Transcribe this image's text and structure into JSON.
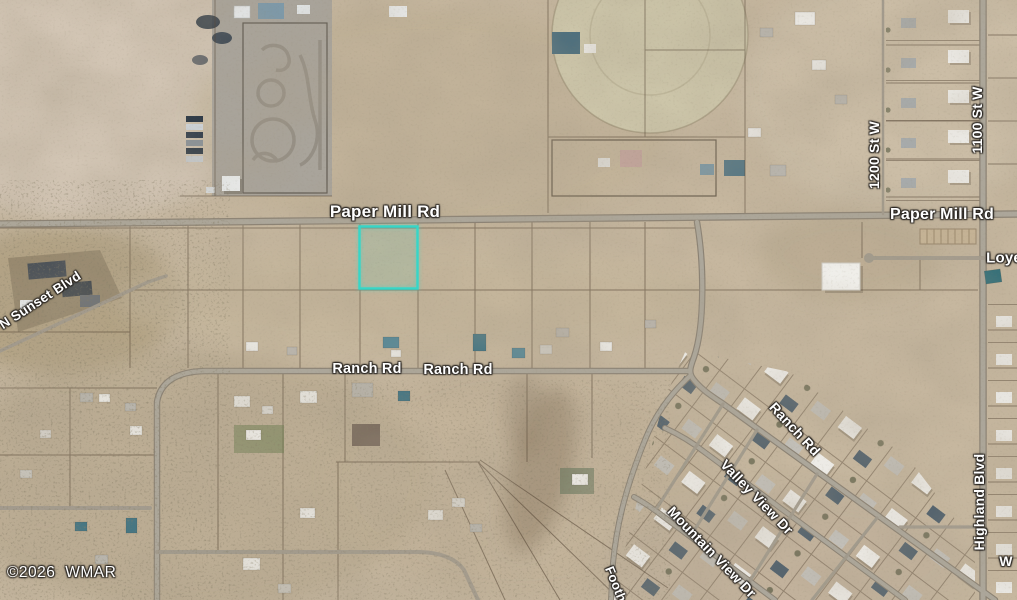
{
  "map": {
    "attribution": "©2026 WMAR",
    "highlight": {
      "color": "#36D6C8"
    },
    "road_labels": {
      "paper_mill_west": "Paper Mill Rd",
      "paper_mill_east": "Paper Mill Rd",
      "n_sunset_blvd": "N Sunset Blvd",
      "ranch_rd_west": "Ranch Rd",
      "ranch_rd_center": "Ranch Rd",
      "ranch_rd_diagonal": "Ranch Rd",
      "st_1200_w": "1200 St W",
      "st_1100_w": "1100 St W",
      "highland_blvd": "Highland Blvd",
      "valley_view_dr": "Valley View Dr",
      "mountain_view_dr": "Mountain View Dr",
      "foothill_partial": "Footh",
      "loye_partial": "Loye",
      "w_partial": "W"
    }
  }
}
